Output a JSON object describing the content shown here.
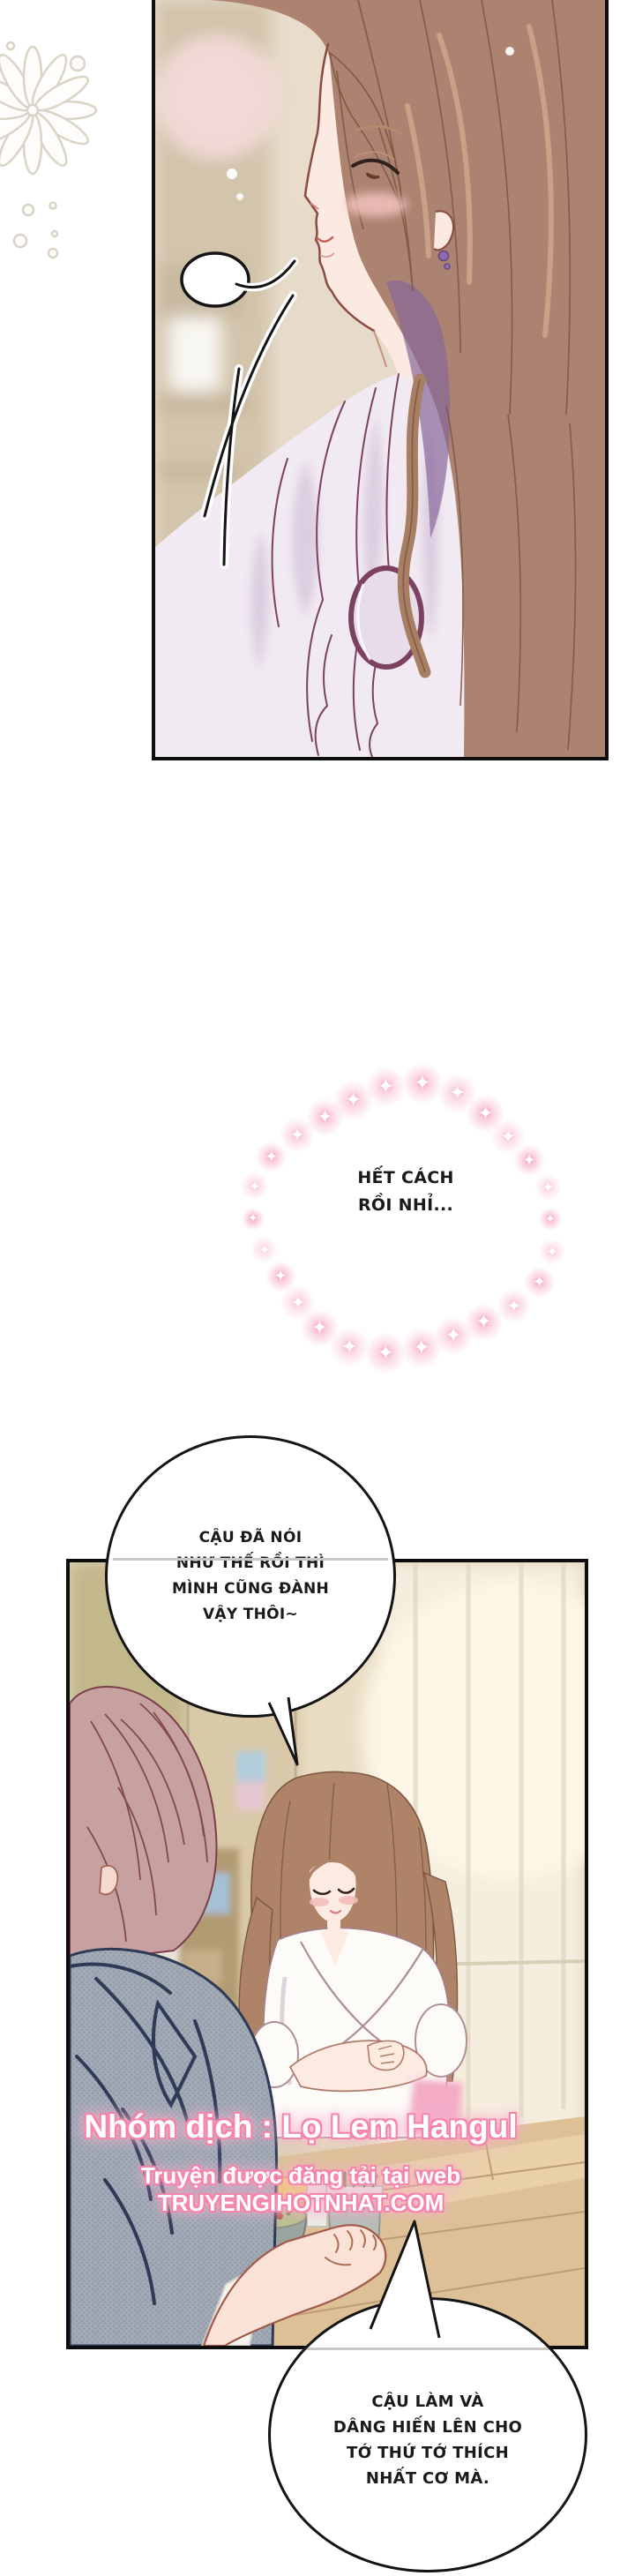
{
  "bubbles": {
    "thought": {
      "lines": [
        "HẾT CÁCH",
        "RỒI NHỈ..."
      ]
    },
    "speech_top": {
      "lines": [
        "CẬU ĐÃ NÓI",
        "NHƯ THẾ RỒI THÌ",
        "MÌNH CŨNG ĐÀNH",
        "VẬY THÔI~"
      ]
    },
    "speech_bottom": {
      "lines": [
        "CẬU LÀM VÀ",
        "DÂNG HIẾN LÊN CHO",
        "TỚ THỨ TỚ THÍCH",
        "NHẤT CƠ MÀ."
      ]
    }
  },
  "credits": {
    "group_line": "Nhóm dịch : Lọ Lem Hangul",
    "site_line": "Truyện được đăng tải tại web TRUYENGIHOTNHAT.COM"
  },
  "colors": {
    "credit_glow": "#f584ab",
    "sparkle_pink": "#f6b9cb",
    "panel_border": "#0d0d0d",
    "paper": "#ffffff"
  },
  "icons": {
    "sparkle_glyph": "✦",
    "flower_doodle": "flower-doodle"
  }
}
